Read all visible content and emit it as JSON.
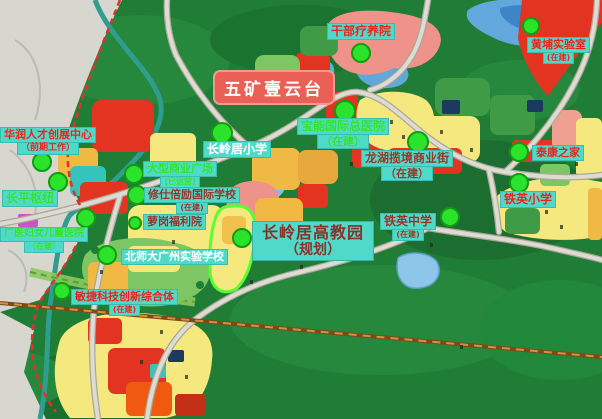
{
  "map": {
    "banner": {
      "text": "五矿壹云台"
    },
    "district_label": {
      "line1": "长岭居高教园",
      "line2": "（规划）"
    },
    "colors": {
      "label_box_cyan": "#4ed9c9",
      "banner_red": "#ea5f56",
      "marker_green": "#2ce32c",
      "label_text_red": "#e8231c",
      "label_text_green": "#2fe32f",
      "label_text_white": "#ffffff",
      "label_text_darkred": "#93352a",
      "forest_green": "#1f7d35",
      "parcel_yellow": "#f5e87e",
      "parcel_red": "#e23420"
    },
    "labels": [
      {
        "id": "ganbu-sanatorium",
        "text": "干部疗养院",
        "sub": "",
        "color": "red",
        "x": 327,
        "y": 23,
        "fs": 12,
        "subFs": 8
      },
      {
        "id": "huangpu-lab",
        "text": "黄埔实验室",
        "sub": "(在建)",
        "color": "red",
        "x": 527,
        "y": 37,
        "fs": 11,
        "subFs": 8
      },
      {
        "id": "huarun-talent-center",
        "text": "华润人才创展中心",
        "sub": "（前期工作）",
        "color": "red",
        "x": 0,
        "y": 127,
        "fs": 11,
        "subFs": 9
      },
      {
        "id": "changlingju-primary-school",
        "text": "长岭居小学",
        "sub": "",
        "color": "white",
        "x": 203,
        "y": 141,
        "fs": 12,
        "subFs": 8
      },
      {
        "id": "baoneng-hospital",
        "text": "宝能国际总医院",
        "sub": "（在建）",
        "color": "green",
        "x": 297,
        "y": 118,
        "fs": 12,
        "subFs": 11
      },
      {
        "id": "taikang-home",
        "text": "泰康之家",
        "sub": "",
        "color": "red",
        "x": 532,
        "y": 145,
        "fs": 11,
        "subFs": 8
      },
      {
        "id": "longhu-commercial-street",
        "text": "龙湖揽境商业街",
        "sub": "（在建）",
        "color": "darkred",
        "x": 361,
        "y": 150,
        "fs": 12,
        "subFs": 11
      },
      {
        "id": "changping-hub",
        "text": "长平枢纽",
        "sub": "",
        "color": "green",
        "x": 2,
        "y": 190,
        "fs": 12,
        "subFs": 8
      },
      {
        "id": "commercial-plaza",
        "text": "大型商业广场",
        "sub": "(已运营)",
        "color": "green",
        "x": 143,
        "y": 161,
        "fs": 11,
        "subFs": 8
      },
      {
        "id": "xiushibeili-school",
        "text": "修仕倍励国际学校",
        "sub": "(在建)",
        "color": "darkred",
        "x": 144,
        "y": 187,
        "fs": 11,
        "subFs": 8
      },
      {
        "id": "tieying-middle-school",
        "text": "铁英中学",
        "sub": "(在建)",
        "color": "darkred",
        "x": 380,
        "y": 213,
        "fs": 12,
        "subFs": 8
      },
      {
        "id": "tieying-primary-school",
        "text": "铁英小学",
        "sub": "",
        "color": "red",
        "x": 500,
        "y": 191,
        "fs": 12,
        "subFs": 8
      },
      {
        "id": "luogang-welfare-home",
        "text": "萝岗福利院",
        "sub": "",
        "color": "darkred",
        "x": 143,
        "y": 214,
        "fs": 11,
        "subFs": 8
      },
      {
        "id": "guangyi-women-children-hospital",
        "text": "广医妇女儿童医院",
        "sub": "（在建）",
        "color": "green",
        "x": 0,
        "y": 227,
        "fs": 10,
        "subFs": 8
      },
      {
        "id": "bnu-guangzhou-school",
        "text": "北师大广州实验学校",
        "sub": "",
        "color": "white",
        "x": 121,
        "y": 249,
        "fs": 11,
        "subFs": 8
      },
      {
        "id": "minjie-tech-complex",
        "text": "敏捷科技创新综合体",
        "sub": "(在建)",
        "color": "red",
        "x": 71,
        "y": 289,
        "fs": 11,
        "subFs": 8
      }
    ],
    "markers": [
      {
        "for": "ganbu-sanatorium",
        "x": 361,
        "y": 53,
        "r": 10
      },
      {
        "for": "huangpu-lab",
        "x": 531,
        "y": 26,
        "r": 9
      },
      {
        "for": "changlingju-primary-school",
        "x": 222,
        "y": 133,
        "r": 11
      },
      {
        "for": "baoneng-hospital",
        "x": 345,
        "y": 111,
        "r": 11
      },
      {
        "for": "longhu-commercial-street",
        "x": 418,
        "y": 142,
        "r": 11
      },
      {
        "for": "taikang-home",
        "x": 519,
        "y": 152,
        "r": 10
      },
      {
        "for": "tieying-primary-school",
        "x": 519,
        "y": 183,
        "r": 10
      },
      {
        "for": "tieying-middle-school",
        "x": 450,
        "y": 217,
        "r": 10
      },
      {
        "for": "huarun-talent-center",
        "x": 42,
        "y": 162,
        "r": 10
      },
      {
        "for": "changping-hub",
        "x": 58,
        "y": 182,
        "r": 10
      },
      {
        "for": "commercial-plaza",
        "x": 134,
        "y": 174,
        "r": 10
      },
      {
        "for": "xiushibeili-school",
        "x": 137,
        "y": 195,
        "r": 10
      },
      {
        "for": "luogang-welfare-home",
        "x": 86,
        "y": 218,
        "r": 10
      },
      {
        "for": "luogang-welfare-home-2",
        "x": 135,
        "y": 223,
        "r": 7
      },
      {
        "for": "bnu-guangzhou-school",
        "x": 107,
        "y": 255,
        "r": 10
      },
      {
        "for": "minjie-tech-complex",
        "x": 62,
        "y": 291,
        "r": 9
      },
      {
        "for": "gaojiaoyuan-district",
        "x": 242,
        "y": 238,
        "r": 10
      }
    ]
  }
}
